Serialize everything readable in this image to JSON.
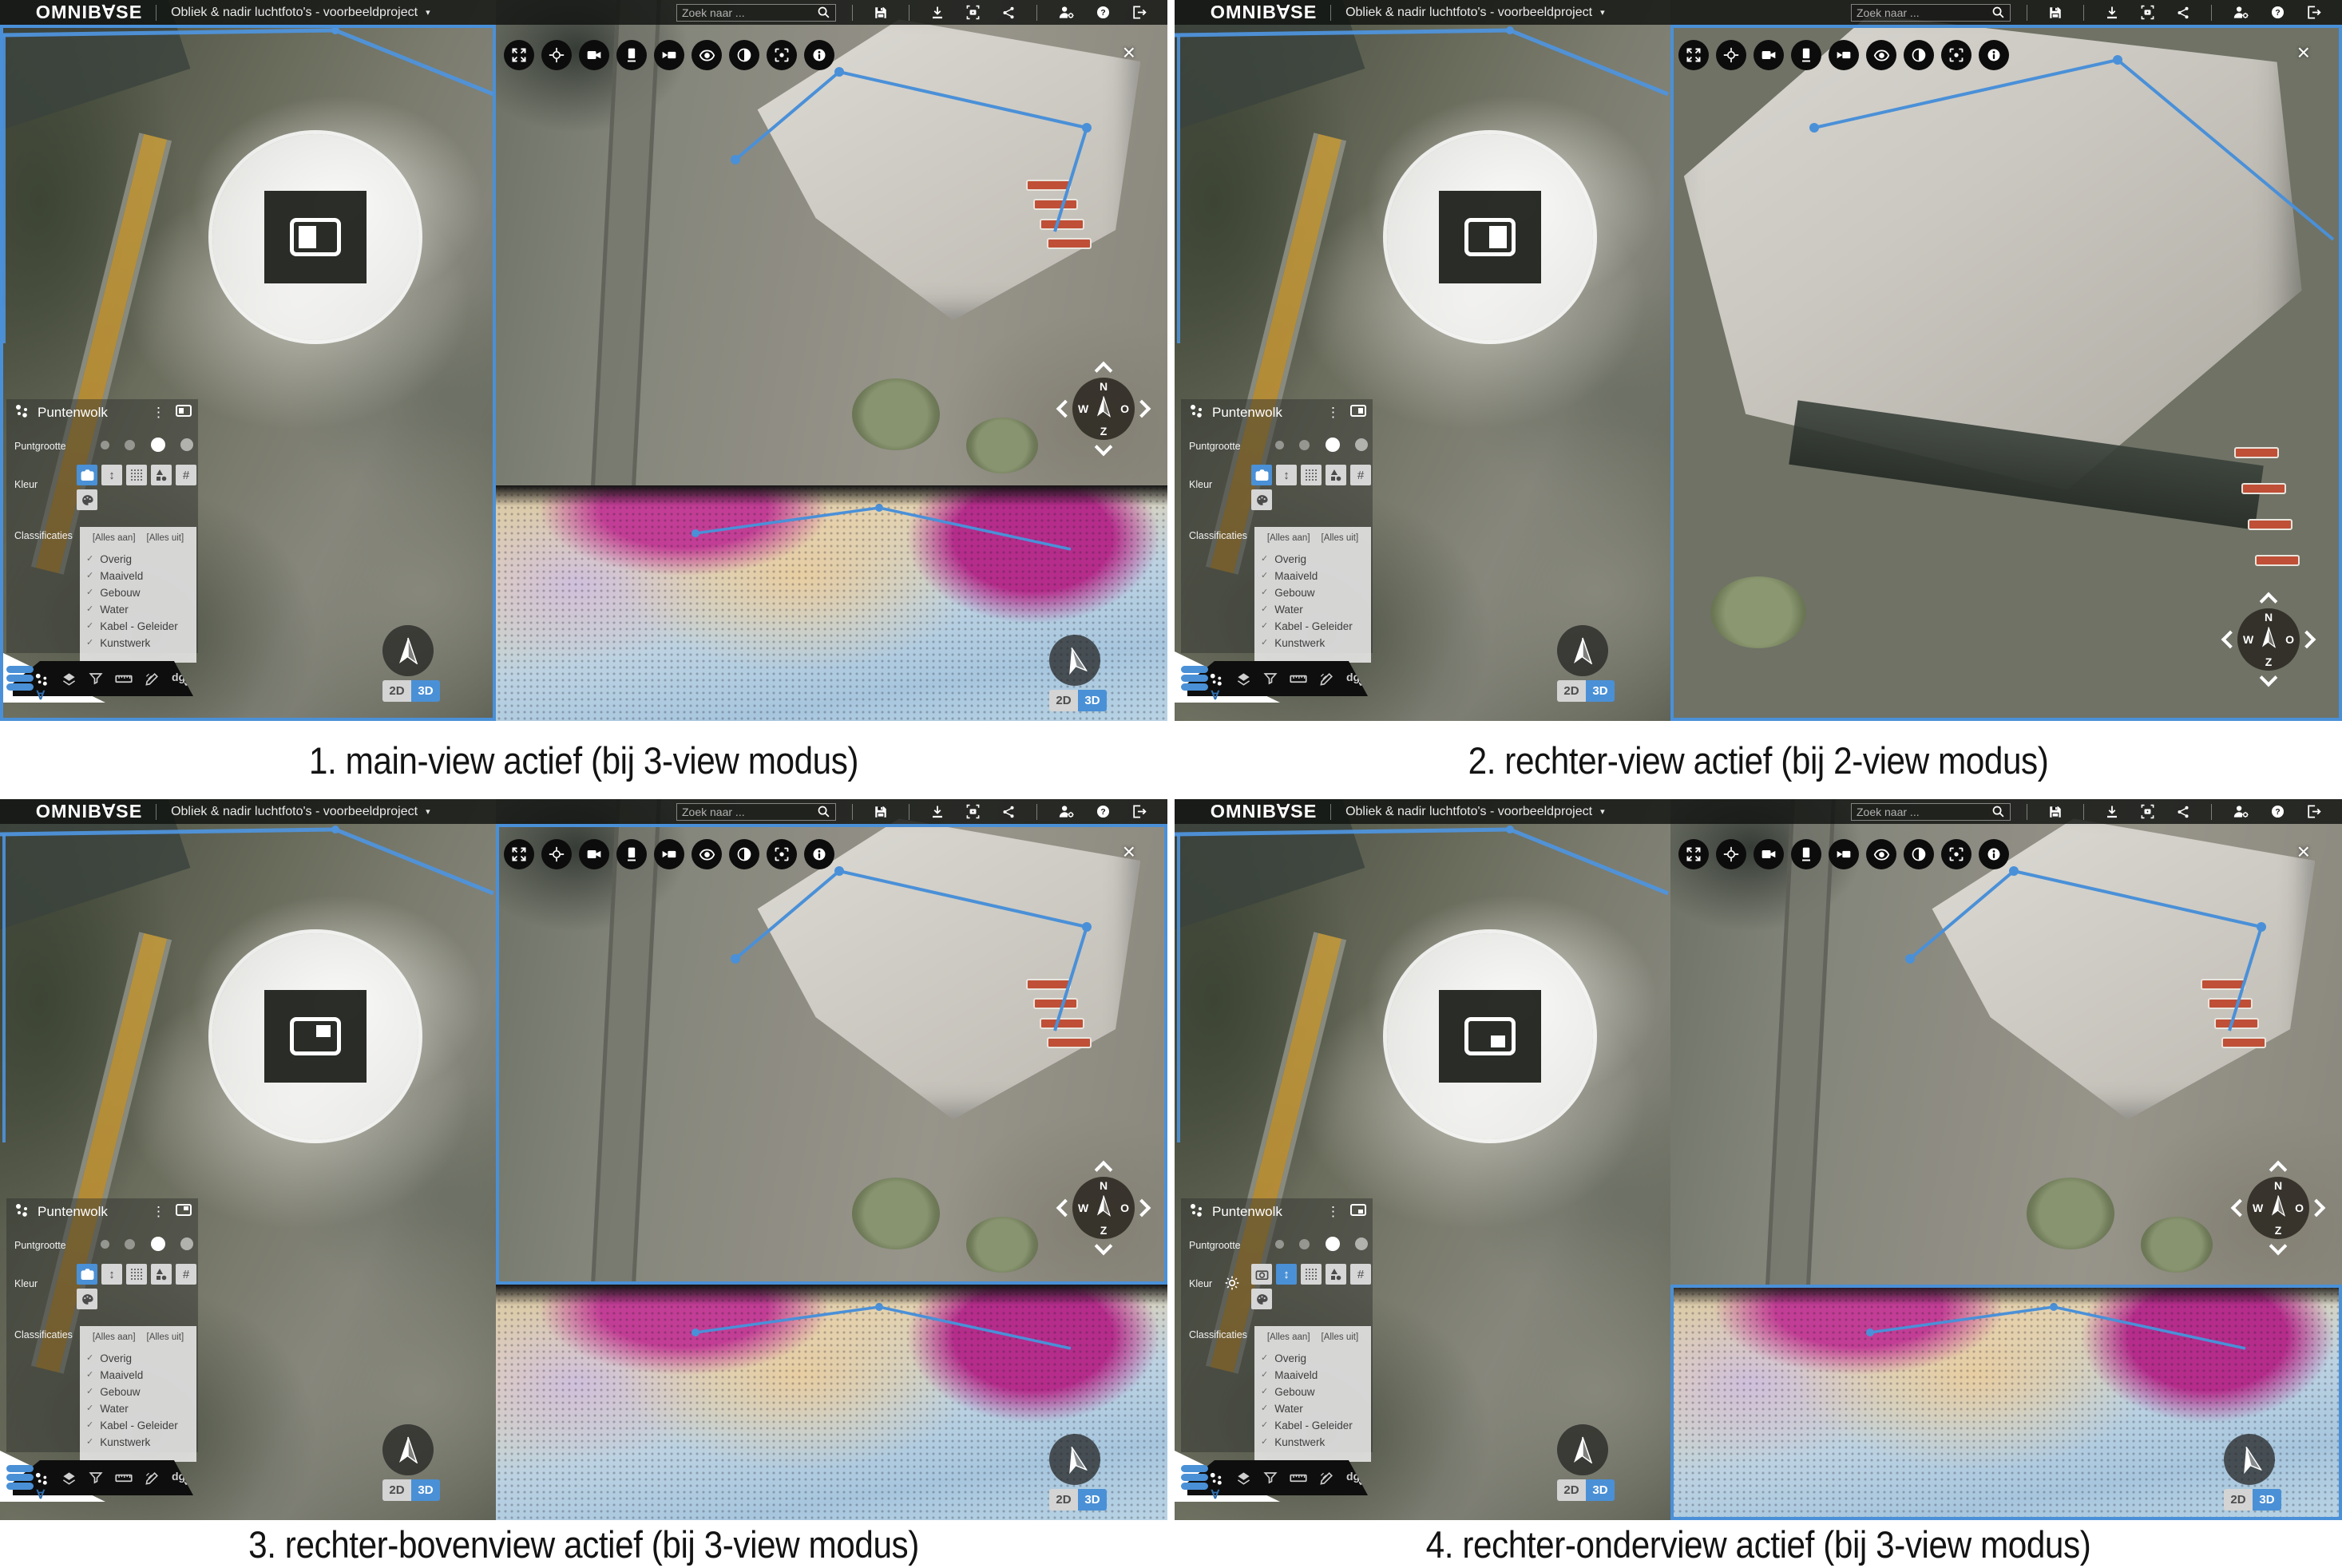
{
  "colors": {
    "accent_blue": "#4a90d6",
    "active_border_blue": "#4a90d8",
    "toolbar_black": "#0c0c0c",
    "button_gray": "#d6d6d6"
  },
  "topbar": {
    "logo": "OMNIB∀SE",
    "project_title": "Obliek & nadir luchtfoto's - voorbeeldproject",
    "caret": "▾",
    "search_placeholder": "Zoek naar ...",
    "icons": [
      "search-icon",
      "save-icon",
      "download-icon",
      "screenshot-icon",
      "share-icon",
      "user-settings-icon",
      "help-icon",
      "logout-icon"
    ]
  },
  "right_toolbar": {
    "icons": [
      "expand-icon",
      "crosshair-icon",
      "videocam-icon",
      "screen-icon",
      "video-icon",
      "eye-icon",
      "contrast-icon",
      "center-focus-icon",
      "info-icon"
    ],
    "close": "×"
  },
  "panel": {
    "title": "Puntenwolk",
    "menu": "⋮",
    "size_label": "Puntgrootte",
    "color_label": "Kleur",
    "class_label": "Classificaties",
    "all_on": "[Alles aan]",
    "all_off": "[Alles uit]",
    "check": "✓",
    "classes": [
      "Overig",
      "Maaiveld",
      "Gebouw",
      "Water",
      "Kabel - Geleider",
      "Kunstwerk"
    ],
    "color_buttons": [
      "photo",
      "height",
      "intensity",
      "classification",
      "grid",
      "palette"
    ],
    "point_sizes": 4,
    "selected_point_size_index": 2
  },
  "bottom_toolbar": {
    "icons": [
      "pointcloud-icon",
      "layers-icon",
      "filter-icon",
      "ruler-icon",
      "draw-icon",
      "dg-icon"
    ],
    "dg_label": "dg"
  },
  "viewport": {
    "mode_2d": "2D",
    "mode_3d": "3D",
    "compass": {
      "n": "N",
      "w": "W",
      "o": "O",
      "z": "Z"
    }
  },
  "quadrants": [
    {
      "caption": "1. main-view actief (bij 3-view modus)",
      "views": 3,
      "active_view": "main",
      "loupe": "main",
      "kleur_selected": "photo",
      "show_color_settings_gear": false
    },
    {
      "caption": "2. rechter-view actief (bij 2-view modus)",
      "views": 2,
      "active_view": "right",
      "loupe": "right",
      "kleur_selected": "photo",
      "show_color_settings_gear": false
    },
    {
      "caption": "3. rechter-bovenview actief (bij 3-view modus)",
      "views": 3,
      "active_view": "right-top",
      "loupe": "top-right",
      "kleur_selected": "photo",
      "show_color_settings_gear": false
    },
    {
      "caption": "4. rechter-onderview actief (bij 3-view modus)",
      "views": 3,
      "active_view": "right-bottom",
      "loupe": "bottom-right",
      "kleur_selected": "height",
      "show_color_settings_gear": true
    }
  ]
}
